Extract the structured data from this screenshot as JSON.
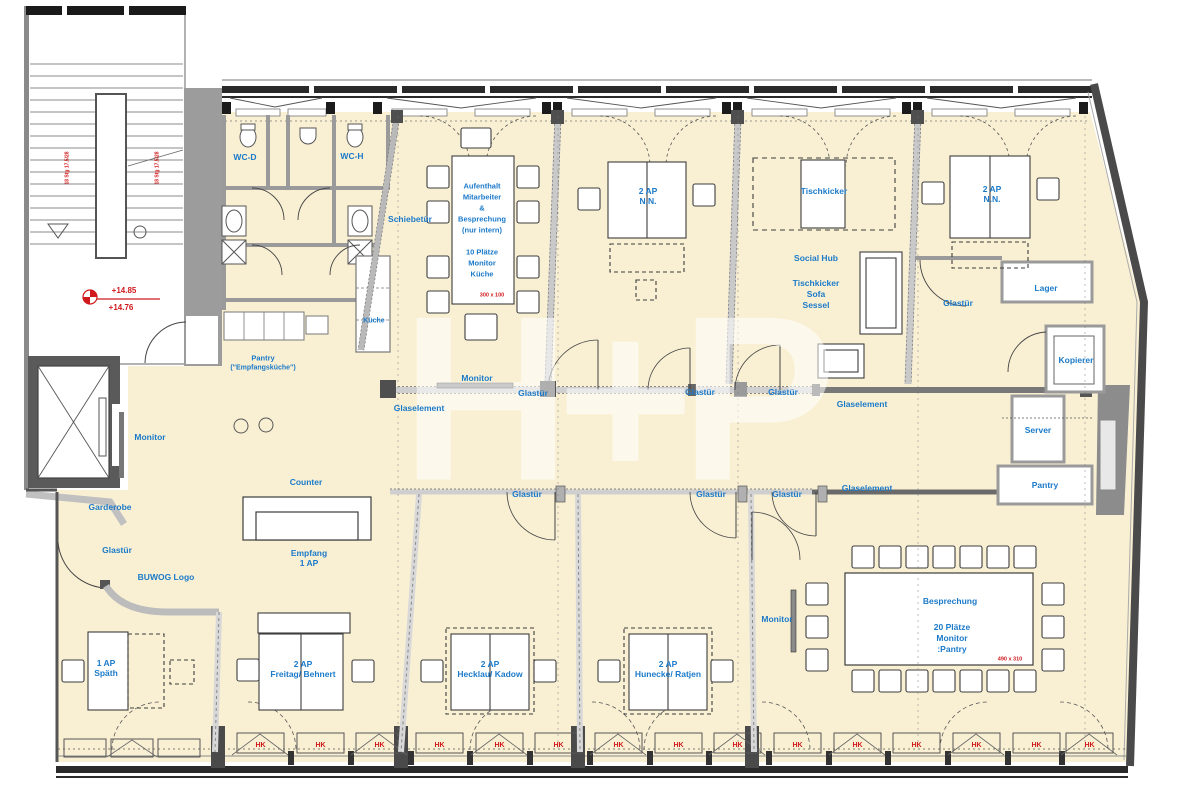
{
  "colors": {
    "floor": "#f9f0d4",
    "label_blue": "#1b7ac9",
    "annotation_red": "#d0191c",
    "wall_dark": "#4a4a4a",
    "wall_light": "#c9c9c9"
  },
  "watermark": "H+P",
  "stairwell": {
    "level_upper": "+14.85",
    "level_lower": "+14.76",
    "risers_left": "18 Stg 17,5/28",
    "risers_right": "18 Stg 17,5/28"
  },
  "wc": {
    "d": "WC-D",
    "h": "WC-H"
  },
  "kitchen": {
    "cabinet": "Küche",
    "pantry1": "Pantry",
    "pantry2": "(\"Empfangsküche\")"
  },
  "aufenthalt": {
    "l1": "Aufenthalt",
    "l2": "Mitarbeiter",
    "l3": "&",
    "l4": "Besprechung",
    "l5": "(nur intern)",
    "l6": "10 Plätze",
    "l7": "Monitor",
    "l8": "Küche",
    "dim": "300 x 100"
  },
  "rooms": {
    "nn": {
      "l1": "2 AP",
      "l2": "N.N."
    },
    "tischkicker": "Tischkicker",
    "social": {
      "title": "Social Hub",
      "a": "Tischkicker",
      "b": "Sofa",
      "c": "Sessel"
    },
    "lager": "Lager",
    "kopierer": "Kopierer",
    "server": "Server",
    "pantry": "Pantry",
    "spaeth": {
      "l1": "1 AP",
      "l2": "Späth"
    },
    "freitag": {
      "l1": "2 AP",
      "l2": "Freitag/ Behnert"
    },
    "hecklau": {
      "l1": "2 AP",
      "l2": "Hecklau/ Kadow"
    },
    "hunecke": {
      "l1": "2 AP",
      "l2": "Hunecke/ Ratjen"
    },
    "besprechung": {
      "title": "Besprechung",
      "l1": "20 Plätze",
      "l2": "Monitor",
      "l3": ":Pantry",
      "dim": "490 x 310"
    }
  },
  "reception": {
    "counter": "Counter",
    "empfang1": "Empfang",
    "empfang2": "1 AP",
    "monitor": "Monitor",
    "garderobe": "Garderobe",
    "buwog": "BUWOG Logo"
  },
  "annotations": {
    "glastuer": "Glastür",
    "glaselement": "Glaselement",
    "schiebetuer": "Schiebetür",
    "monitor": "Monitor",
    "hk": "HK"
  }
}
